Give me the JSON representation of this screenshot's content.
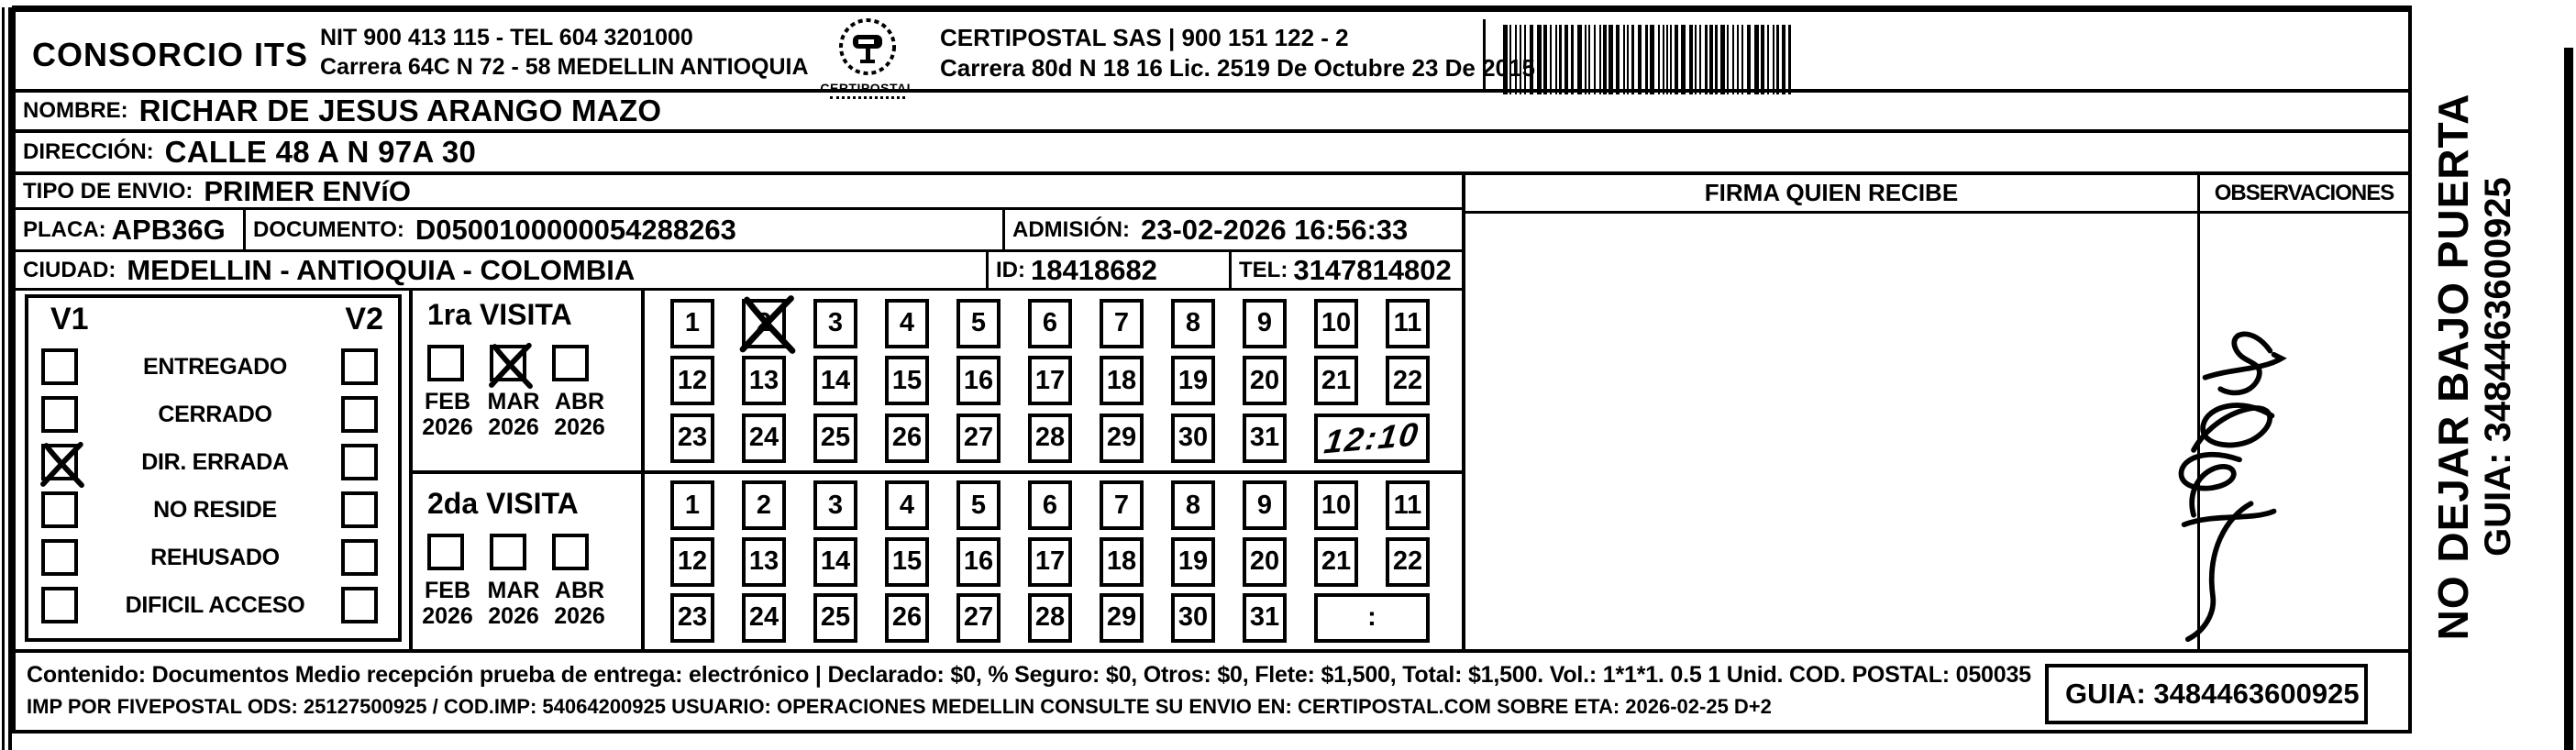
{
  "header": {
    "company": "CONSORCIO ITS",
    "company_nit": "NIT 900 413 115 - TEL 604 3201000",
    "company_address": "Carrera 64C N 72 - 58 MEDELLIN ANTIOQUIA",
    "logo_caption": "CERTIPOSTAL",
    "provider": "CERTIPOSTAL SAS | 900 151 122 - 2",
    "provider_address": "Carrera 80d N 18 16  Lic. 2519 De Octubre 23 De 2015",
    "barcode_value": "3484463600925"
  },
  "shipment": {
    "nombre_label": "NOMBRE:",
    "nombre": "RICHAR DE JESUS ARANGO MAZO",
    "direccion_label": "DIRECCIÓN:",
    "direccion": "CALLE 48 A N 97A 30",
    "tipo_label": "TIPO DE ENVIO:",
    "tipo": "PRIMER ENVíO",
    "placa_label": "PLACA:",
    "placa": "APB36G",
    "documento_label": "DOCUMENTO:",
    "documento": "D0500100000054288263",
    "admision_label": "ADMISIÓN:",
    "admision": "23-02-2026 16:56:33",
    "ciudad_label": "CIUDAD:",
    "ciudad": "MEDELLIN - ANTIOQUIA - COLOMBIA",
    "id_label": "ID:",
    "id_value": "18418682",
    "tel_label": "TEL:",
    "tel": "3147814802"
  },
  "status": {
    "v1_label": "V1",
    "v2_label": "V2",
    "options": [
      {
        "label": "ENTREGADO",
        "v1": false,
        "v2": false
      },
      {
        "label": "CERRADO",
        "v1": false,
        "v2": false
      },
      {
        "label": "DIR. ERRADA",
        "v1": true,
        "v2": false
      },
      {
        "label": "NO RESIDE",
        "v1": false,
        "v2": false
      },
      {
        "label": "REHUSADO",
        "v1": false,
        "v2": false
      },
      {
        "label": "DIFICIL ACCESO",
        "v1": false,
        "v2": false
      }
    ]
  },
  "visits": [
    {
      "title": "1ra VISITA",
      "months": [
        {
          "month": "FEB",
          "year": "2026",
          "checked": false
        },
        {
          "month": "MAR",
          "year": "2026",
          "checked": true
        },
        {
          "month": "ABR",
          "year": "2026",
          "checked": false
        }
      ],
      "crossed_day": 2,
      "time_note": "12:10",
      "time_handwritten": true
    },
    {
      "title": "2da VISITA",
      "months": [
        {
          "month": "FEB",
          "year": "2026",
          "checked": false
        },
        {
          "month": "MAR",
          "year": "2026",
          "checked": false
        },
        {
          "month": "ABR",
          "year": "2026",
          "checked": false
        }
      ],
      "crossed_day": null,
      "time_note": ":",
      "time_handwritten": false
    }
  ],
  "signature_panel": {
    "firma_header": "FIRMA QUIEN RECIBE",
    "observaciones_header": "OBSERVACIONES"
  },
  "side_note": {
    "line1": "NO DEJAR BAJO PUERTA",
    "line2": "GUIA: 3484463600925"
  },
  "footer": {
    "line1": "Contenido: Documentos Medio recepción prueba de entrega: electrónico | Declarado: $0, % Seguro: $0, Otros: $0, Flete: $1,500, Total: $1,500. Vol.: 1*1*1. 0.5  1 Unid. COD. POSTAL: 050035",
    "line2": "IMP POR FIVEPOSTAL ODS: 25127500925 / COD.IMP: 54064200925 USUARIO: OPERACIONES MEDELLIN CONSULTE SU ENVIO EN: CERTIPOSTAL.COM SOBRE ETA: 2026-02-25 D+2",
    "guia": "GUIA: 3484463600925"
  }
}
